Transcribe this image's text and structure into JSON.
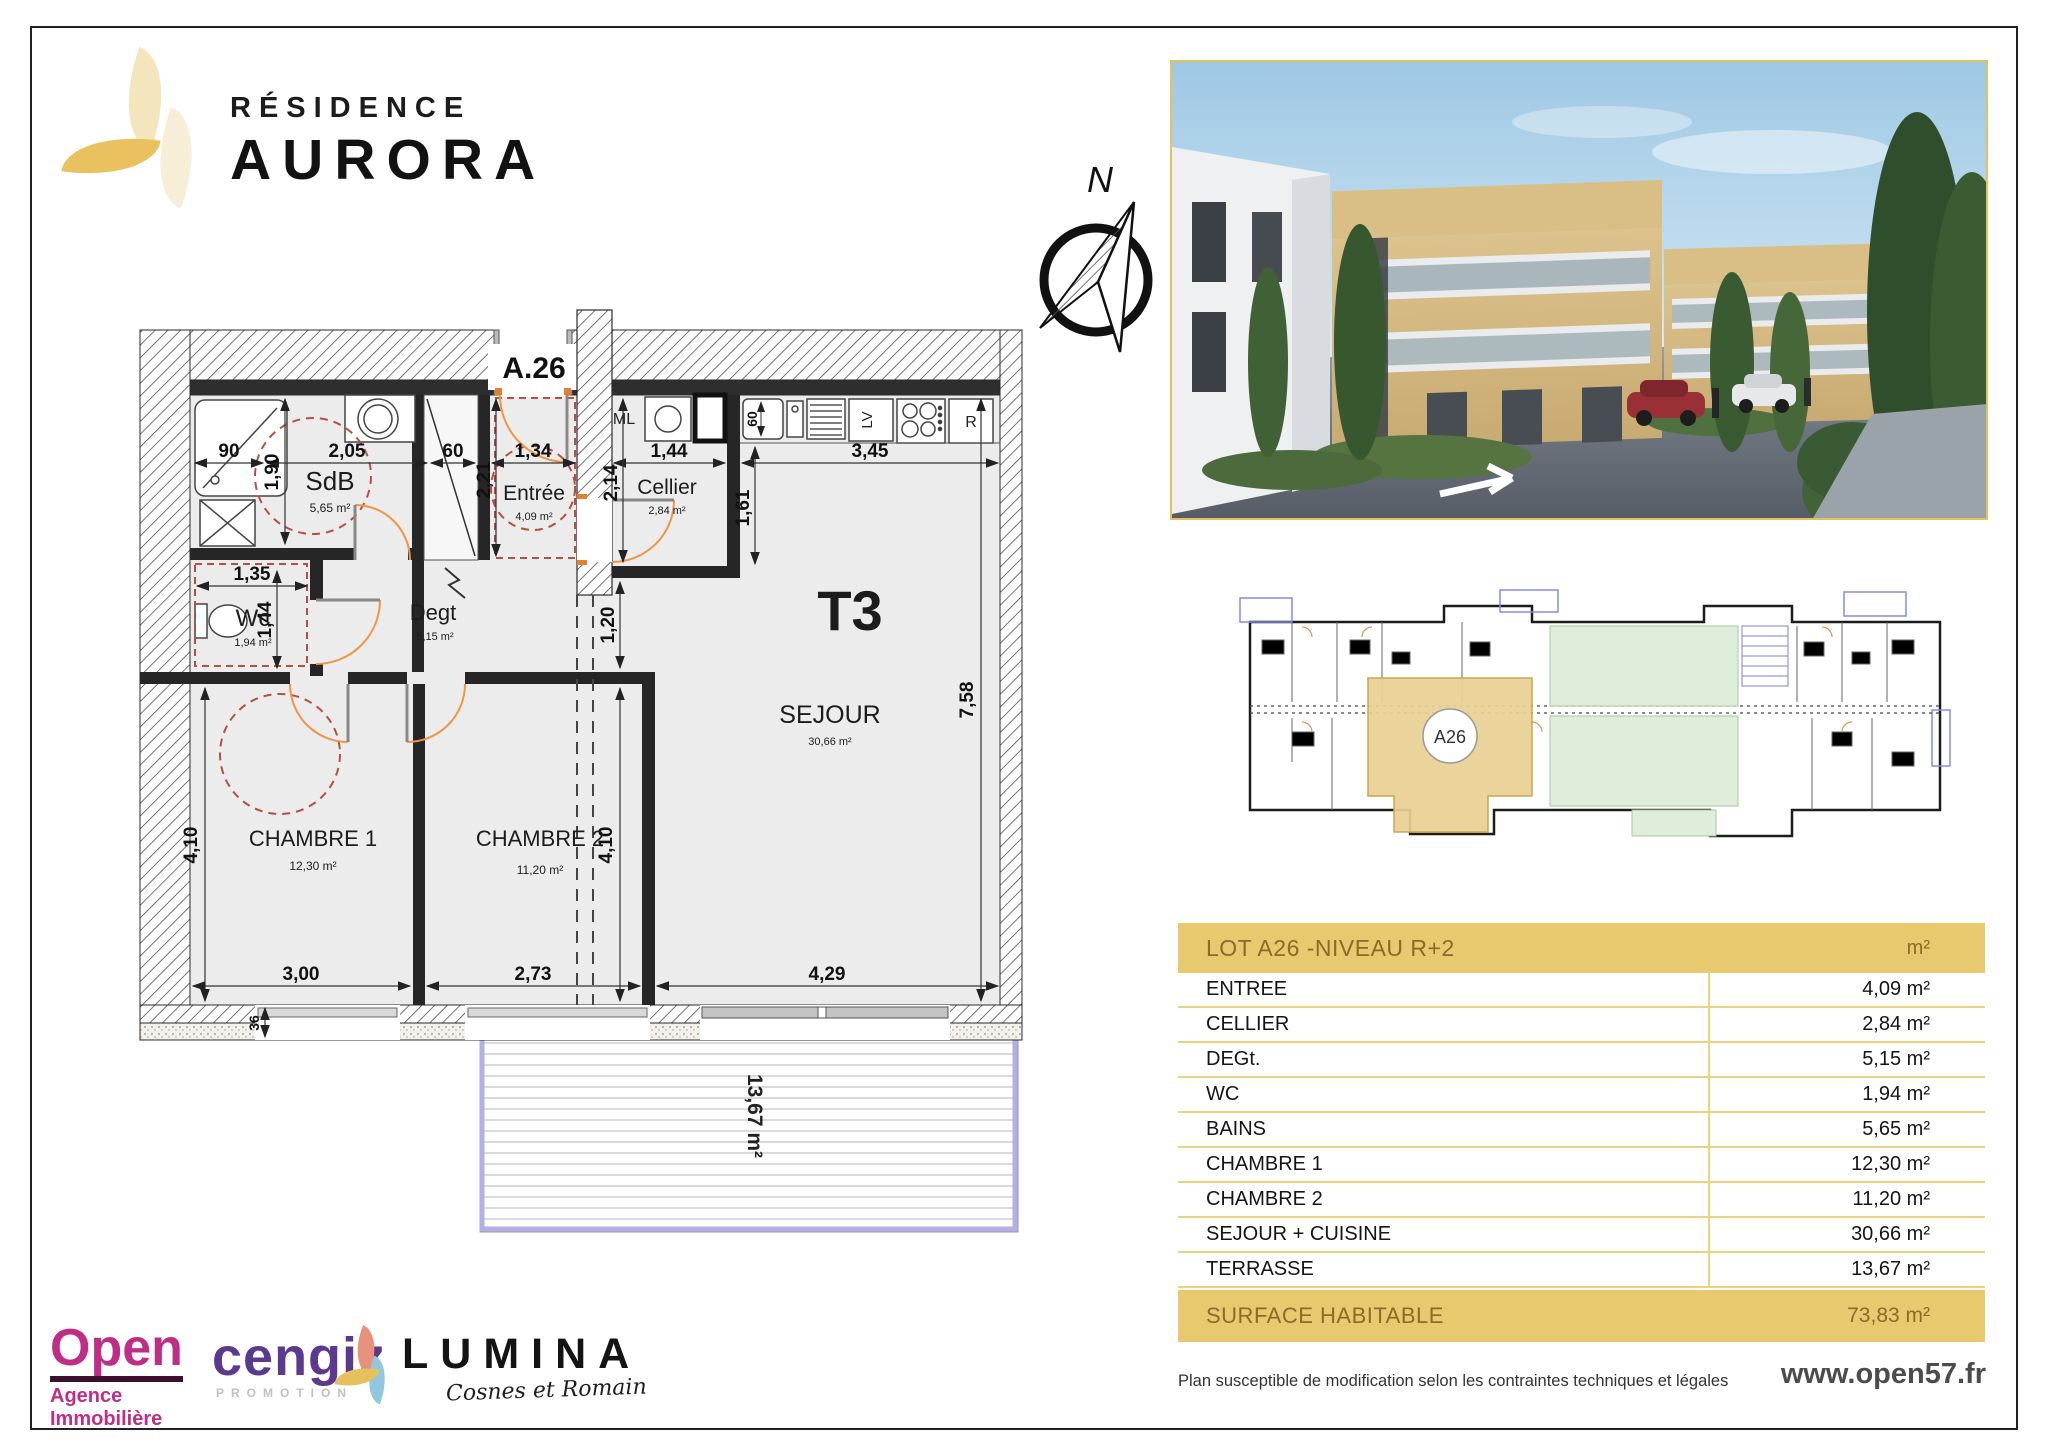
{
  "brand": {
    "line1": "RÉSIDENCE",
    "line2": "AURORA"
  },
  "compass": {
    "north": "N"
  },
  "plan": {
    "unit": "A.26",
    "type": "T3",
    "rooms": {
      "sdb": {
        "name": "SdB",
        "area": "5,65 m²"
      },
      "entree": {
        "name": "Entrée",
        "area": "4,09 m²"
      },
      "cellier": {
        "name": "Cellier",
        "area": "2,84 m²"
      },
      "wc": {
        "name": "Wc",
        "area": "1,94 m²"
      },
      "degt": {
        "name": "Degt",
        "area": "5,15 m²"
      },
      "sejour": {
        "name": "SEJOUR",
        "area": "30,66 m²"
      },
      "ch1": {
        "name": "CHAMBRE 1",
        "area": "12,30 m²"
      },
      "ch2": {
        "name": "CHAMBRE 2",
        "area": "11,20 m²"
      }
    },
    "terrace_area": "13,67 m²",
    "appliances": {
      "ml": "ML",
      "lv": "LV",
      "fridge": "R"
    },
    "dims": {
      "w90": "90",
      "w205": "2,05",
      "w60": "60",
      "w134": "1,34",
      "w144": "1,44",
      "w345": "3,45",
      "h190": "1,90",
      "h221": "2,21",
      "h214": "2,14",
      "h161": "1,61",
      "wcw": "1,35",
      "wch": "1,44",
      "h120": "1,20",
      "h758": "7,58",
      "left410": "4,10",
      "mid410": "4,10",
      "w300": "3,00",
      "w273": "2,73",
      "w429": "4,29",
      "w36": "36",
      "sink60": "60"
    }
  },
  "keyplan": {
    "badge": "A26"
  },
  "table": {
    "title": "LOT A26  -NIVEAU R+2",
    "unit_header": "m²",
    "rows": [
      {
        "label": "ENTREE",
        "value": "4,09 m²"
      },
      {
        "label": "CELLIER",
        "value": "2,84 m²"
      },
      {
        "label": "DEGt.",
        "value": "5,15 m²"
      },
      {
        "label": "WC",
        "value": "1,94 m²"
      },
      {
        "label": "BAINS",
        "value": "5,65 m²"
      },
      {
        "label": "CHAMBRE 1",
        "value": "12,30 m²"
      },
      {
        "label": "CHAMBRE 2",
        "value": "11,20 m²"
      },
      {
        "label": "SEJOUR + CUISINE",
        "value": "30,66 m²"
      },
      {
        "label": "TERRASSE",
        "value": "13,67 m²"
      }
    ],
    "footer": {
      "label": "SURFACE HABITABLE",
      "value": "73,83 m²"
    }
  },
  "partners": {
    "open": {
      "name": "Open",
      "sub": "Agence Immobilière"
    },
    "cengiz": {
      "name": "cengiz",
      "sub": "PROMOTION"
    },
    "lumina": {
      "name": "LUMINA",
      "sub": "Cosnes et Romain"
    }
  },
  "legal": {
    "disclaimer": "Plan susceptible de modification selon les contraintes techniques et légales",
    "website": "www.open57.fr"
  },
  "colors": {
    "gold": "#e8c96e",
    "gold_line": "#ecd27c",
    "gold_text": "#8a6b2a",
    "door_arc": "#ef9546",
    "pmr_circle": "#b5503f",
    "terrace_edge": "#b3b0e8",
    "open_magenta": "#bf2e86",
    "cengiz_purple": "#5b3a8e",
    "keyplan_green": "#dfeeda"
  }
}
